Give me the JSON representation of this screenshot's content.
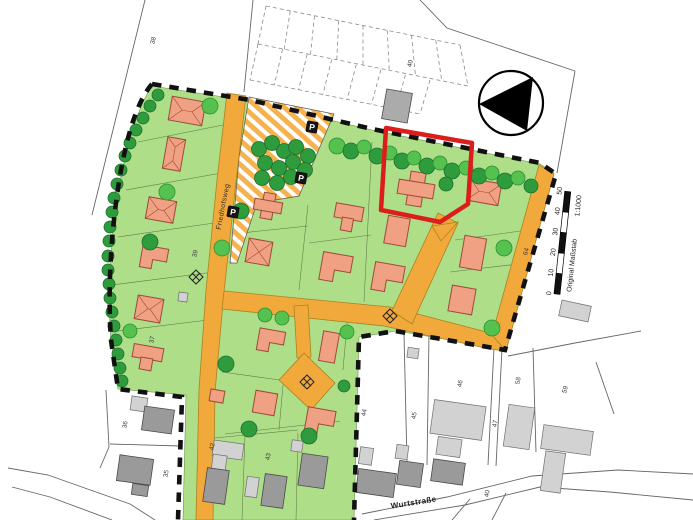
{
  "plan": {
    "street_labels": {
      "friedhofsweg": "Friedhofsweg",
      "wurtstrasse": "Wurtstraße"
    },
    "parking_sign_label": "P",
    "parcel_numbers": {
      "p38": "38",
      "p40_top": "40",
      "p39": "39",
      "p64": "64",
      "p37": "37",
      "p36": "36",
      "p35": "35",
      "p42": "42",
      "p43": "43",
      "p44": "44",
      "p45": "45",
      "p46": "46",
      "p47": "47",
      "p58": "58",
      "p59": "59",
      "p40_s": "40"
    },
    "scale_bar": {
      "label": "Original Maßstab",
      "ratio": "1:1000",
      "ticks": [
        "0",
        "10",
        "20",
        "30",
        "40",
        "50"
      ]
    },
    "north_arrow": {
      "direction": "left"
    },
    "palette": {
      "plot_green": "#aede87",
      "street_orange": "#f2a93b",
      "house_salmon": "#f1a183",
      "tree_dark": "#2e9b3c",
      "tree_light": "#55c14e",
      "existing_building_gray": "#9a9a9a",
      "boundary_black": "#111111",
      "highlight_red": "#dd1c1c"
    }
  }
}
